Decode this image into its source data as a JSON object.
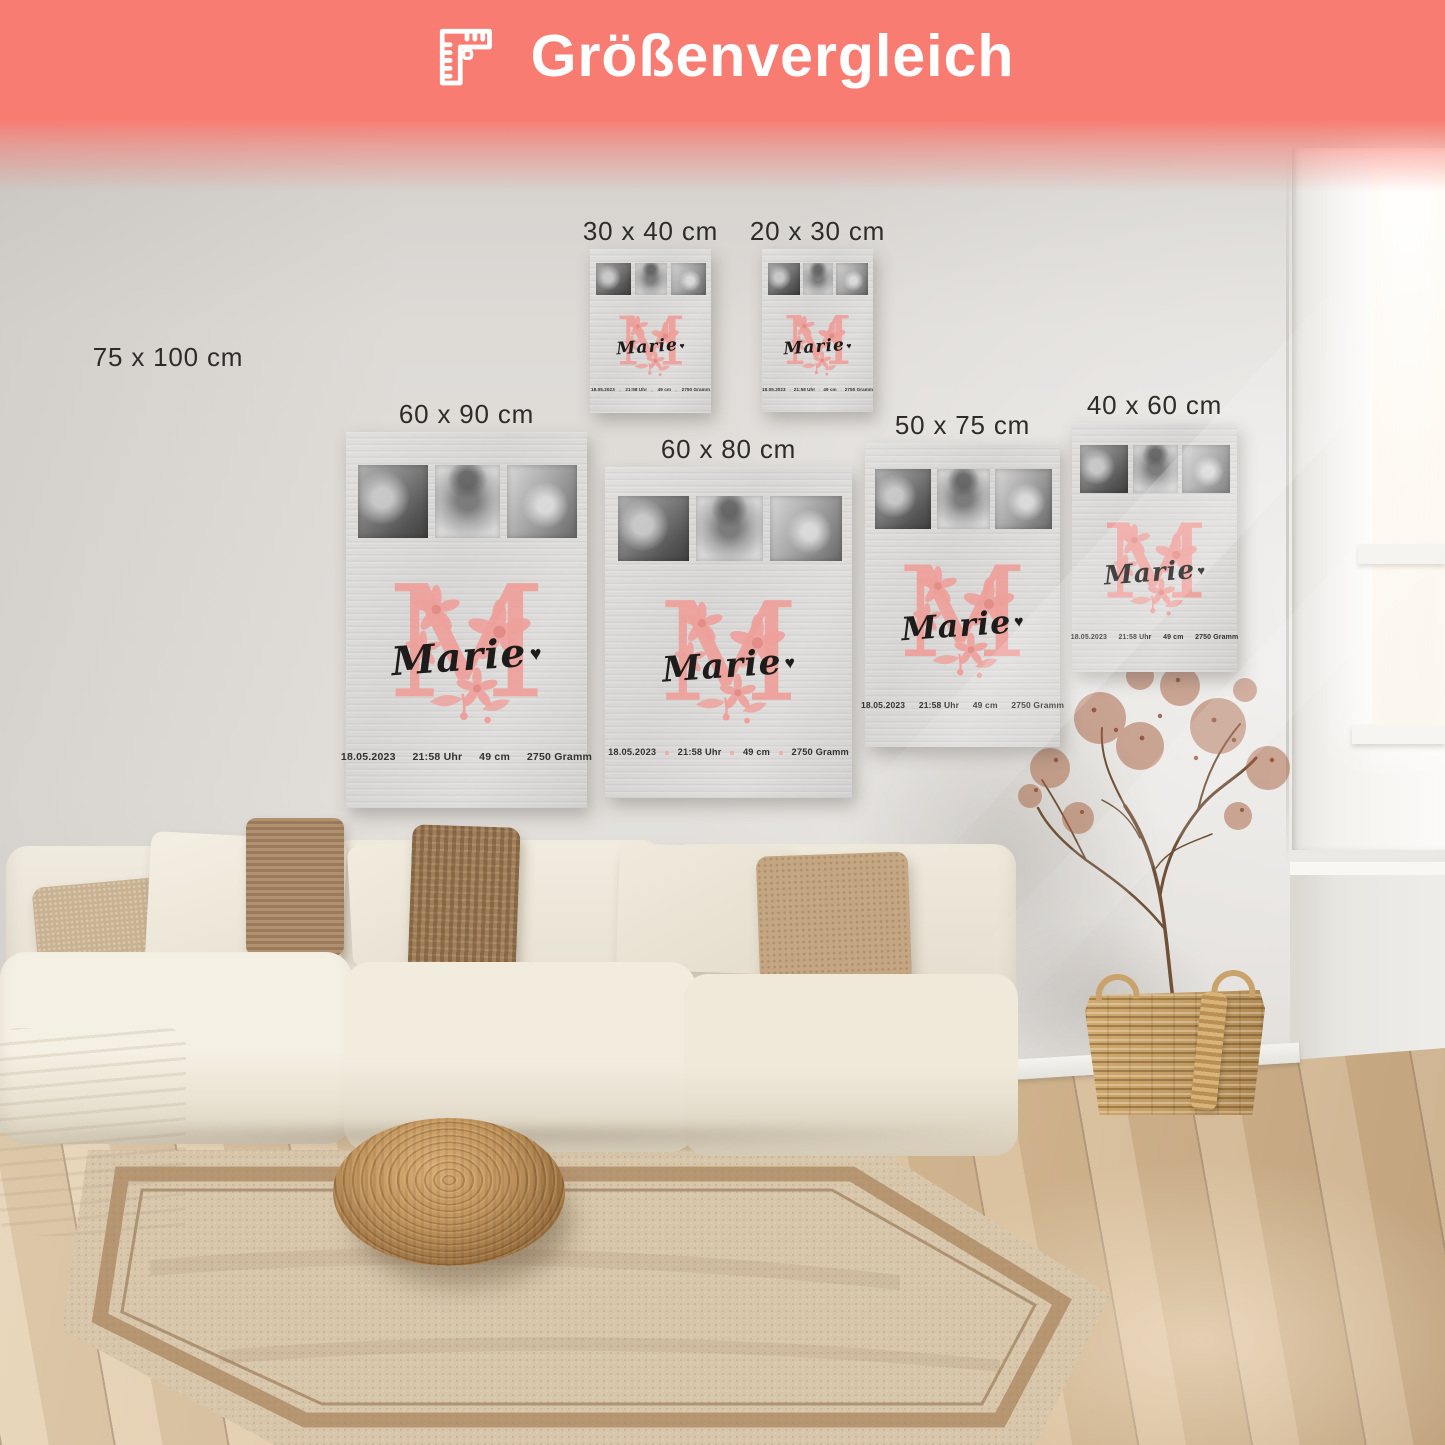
{
  "banner": {
    "title": "Größenvergleich",
    "icon": "ruler-icon",
    "background_color": "#f97c72",
    "text_color": "#ffffff"
  },
  "size_labels": [
    "75 x 100 cm",
    "30 x 40 cm",
    "20 x 30 cm",
    "60 x 90 cm",
    "60 x 80 cm",
    "50 x 75 cm",
    "40 x 60 cm"
  ],
  "poster_design": {
    "monogram_letter": "M",
    "monogram_color": "#efa09b",
    "name": "Marie",
    "heart": "♥",
    "stats": [
      "18.05.2023",
      "21:58 Uhr",
      "49 cm",
      "2750 Gramm"
    ],
    "photo_descriptions": [
      "sleeping-newborn",
      "smiling-baby-with-hat",
      "baby-feet-in-hands"
    ]
  }
}
